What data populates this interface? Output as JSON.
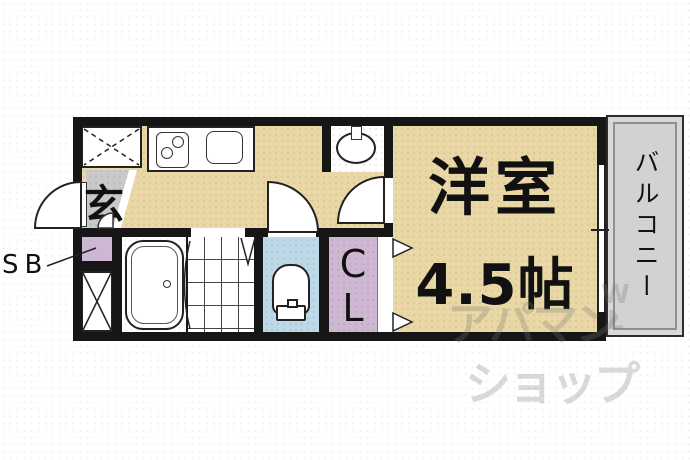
{
  "title": "apartment-floorplan",
  "labels": {
    "entrance": "玄",
    "shoe_box": "SB",
    "closet": [
      "C",
      "L"
    ],
    "room_name": "洋室",
    "room_size": "4.5帖",
    "balcony": "バルコニー"
  },
  "watermark": {
    "line1": "アパマン",
    "line2": "ショップ",
    "side_letters": [
      "W",
      "L"
    ]
  },
  "colors": {
    "floor_tan": "#e9d8a5",
    "genkan_gray": "#c9c9c9",
    "closet_purple": "#cdb7d2",
    "toilet_blue": "#bdd8e7",
    "balcony_gray": "#d8d8d8",
    "balcony_inner_gray": "#d2d2d2",
    "wall_black": "#161616",
    "watermark_gray": "rgba(120,120,120,0.28)"
  },
  "fixtures": [
    "washer-space",
    "kitchen-stove",
    "kitchen-sink",
    "wash-basin",
    "bathtub",
    "toilet",
    "tiled-washroom-floor",
    "storage-box",
    "entrance-door",
    "toilet-door",
    "room-door",
    "closet-folding-door",
    "balcony-window"
  ]
}
